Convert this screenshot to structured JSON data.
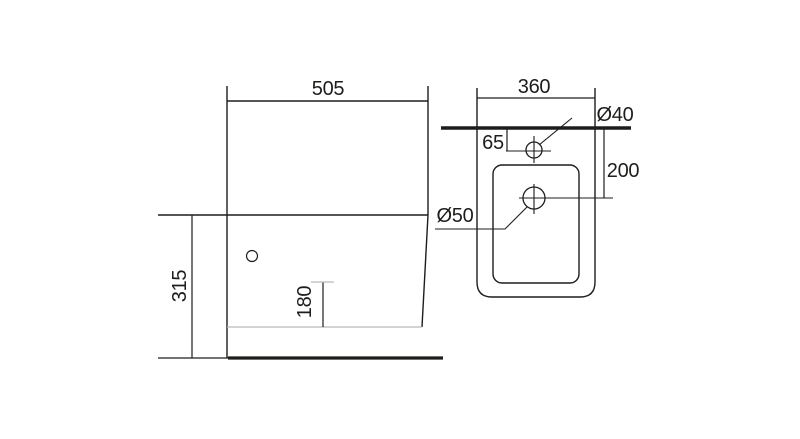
{
  "drawing": {
    "type": "technical-dimension-drawing",
    "subject": "sanitary fixture (bidet) installation drawing, side view and top view",
    "units": "mm",
    "colors": {
      "line": "#1d1d1b",
      "light_line": "#b9b9b9",
      "background": "#ffffff"
    },
    "side_view": {
      "depth": "505",
      "height": "315",
      "spout_height": "180"
    },
    "top_view": {
      "width": "360",
      "faucet_hole_offset": "65",
      "drain_hole_depth": "200",
      "faucet_hole_diameter": "Ø40",
      "drain_hole_diameter": "Ø50"
    }
  }
}
